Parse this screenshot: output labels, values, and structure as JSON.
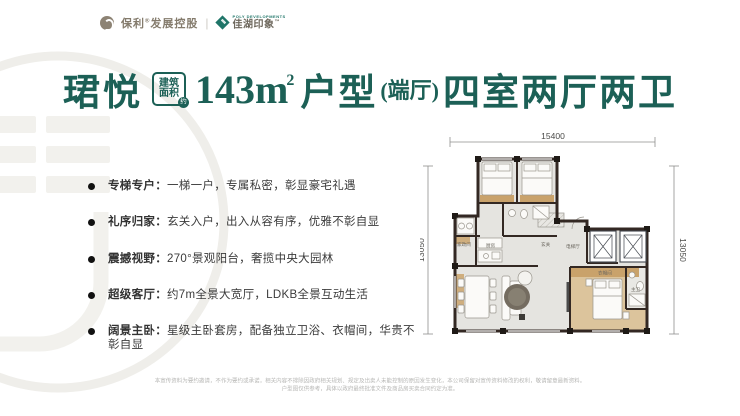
{
  "colors": {
    "accent_teal": "#1c6056",
    "wall": "#332823",
    "wood": "#c9a26b",
    "floor": "#e5e4e0",
    "watermark": "#f0efec"
  },
  "header": {
    "poly_logo_text": "保利",
    "poly_reg_mark": "®",
    "poly_suffix": "发展控股",
    "separator": "|",
    "partner_tagline": "POLY DEVELOPMENTS",
    "partner_logo_text": "佳湖印象",
    "partner_tm": "™"
  },
  "title": {
    "name": "珺悦",
    "badge_line1": "建筑",
    "badge_line2": "面积",
    "badge_circle": "约",
    "area_value": "143m",
    "area_sup": "2",
    "type_label": "户型",
    "paren": "(端厅)",
    "rooms": "四室两厅两卫"
  },
  "features": [
    {
      "label": "专梯专户：",
      "desc": "一梯一户，专属私密，彰显豪宅礼遇"
    },
    {
      "label": "礼序归家：",
      "desc": "玄关入户，出入从容有序，优雅不彰自显"
    },
    {
      "label": "震撼视野：",
      "desc": "270°景观阳台，奢揽中央大园林"
    },
    {
      "label": "超级客厅：",
      "desc": "约7m全景大宽厅，LDKB全景互动生活"
    },
    {
      "label": "阔景主卧：",
      "desc": "星级主卧套房，配备独立卫浴、衣帽间，华贵不彰自显"
    }
  ],
  "floorplan": {
    "dim_top": "15400",
    "dim_left": "13050",
    "dim_right": "13050",
    "labels": {
      "utility": "家政间",
      "kitchen": "厨房",
      "foyer": "玄关",
      "elevator_hall": "电梯厅",
      "closet": "衣帽间",
      "master_bath": "主卫"
    }
  },
  "disclaimer": {
    "line1": "本宣传资料为要约邀请，不作为要约或承诺，相关内容不排除因政府相关规划、规定及出卖人未能控制的原因发生变化，本公司保留对宣传资料修改的权利，敬请留意最新资料。",
    "line2": "户型图仅供参考，具体以政府最终批准文件及商品房买卖合同约定为准。"
  }
}
